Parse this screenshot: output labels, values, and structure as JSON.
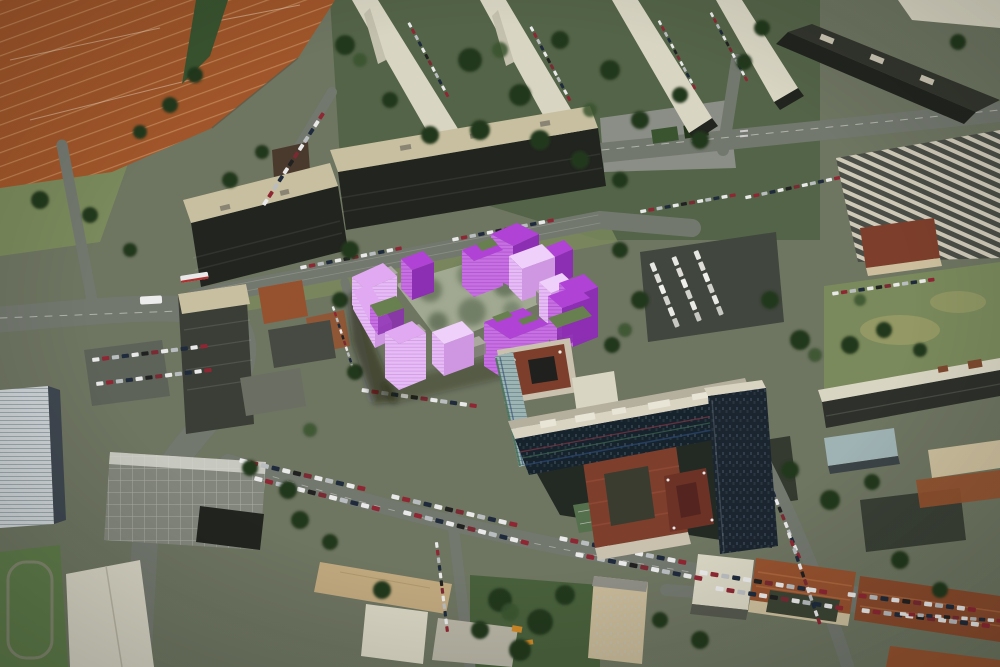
{
  "scene": {
    "type": "aerial-3d-overlay",
    "view": "birds-eye-aerial-photograph",
    "overlay_object": "purple-3d-massing-model-of-proposed-courtyard-building-complex",
    "visible_text": [],
    "regions": [
      "tennis-courts",
      "apartment-slabs-north",
      "long-commercial-buildings",
      "market-stalls",
      "proposed-building-model",
      "inner-courtyard-trees",
      "office-tower-with-striped-facade",
      "red-roof-annex",
      "school-campus",
      "parked-car-rows",
      "old-town-red-roofs",
      "tram-street",
      "boulevard"
    ]
  },
  "colors": {
    "ground": "#6e7561",
    "lawn": "#7a8a5c",
    "lawn_dry": "#a3a169",
    "park_dark": "#49603c",
    "tree_dark": "#24371d",
    "tree_mid": "#3a5430",
    "road": "#73786f",
    "road_dark": "#5e635a",
    "plaza": "#8b8e86",
    "clay": "#a0562a",
    "clay_line": "#d8a878",
    "roof_white": "#d9d5c3",
    "roof_tan": "#c7bf9f",
    "facade_dark": "#22251f",
    "facade_brown": "#4a3a2e",
    "stall_light": "#cfc9b8",
    "stall_dark": "#4a4e46",
    "office_roof": "#d9d3c1",
    "office_facade": "#16222c",
    "office_glass": "#9db4b4",
    "office_base": "#232a24",
    "wing_facade": "#1b2530",
    "court_green": "#55704c",
    "annex_red": "#7d3f2c",
    "annex_cream": "#c9c0ae",
    "town_roof": "#96522f",
    "town_roof_ridge": "#b06a40",
    "town_wall": "#cdbf9e",
    "school_roof": "#83867c",
    "white_bld": "#cdd3d6",
    "gym_roof": "#d6d3c3",
    "sand": "#c0a87e",
    "tan_bld": "#c6b897",
    "blue_roof": "#9fb2b4",
    "model_roof": "#b042d6",
    "model_roof_dark": "#8d2fb2",
    "model_side": "#c770e2",
    "model_side_line": "#9a3cc0",
    "model_pink": "#e2a9f3",
    "model_pink_side": "#e6bcf5",
    "model_pink_line": "#c581dd",
    "model_pink_dark": "#cf97e2",
    "model_pink_top": "#efd0fa",
    "model_gray": "#aaa89f",
    "model_gray_side": "#87857d",
    "model_green": "#687f4f",
    "courtyard": "#99a189",
    "shadow": "rgba(15,25,12,0.45)",
    "car_white": "#e9e9e9",
    "car_red": "#8e2733",
    "car_dark": "#1f2b3d",
    "car_silver": "#b9bdc0",
    "car_black": "#212121",
    "car_maroon": "#7a2a33",
    "stripe_red": "#7d3542",
    "stripe_green": "#3f6a52",
    "stripe_blue": "#2c4a72",
    "digger_orange": "#d08a28",
    "tram_red": "#b03030"
  }
}
